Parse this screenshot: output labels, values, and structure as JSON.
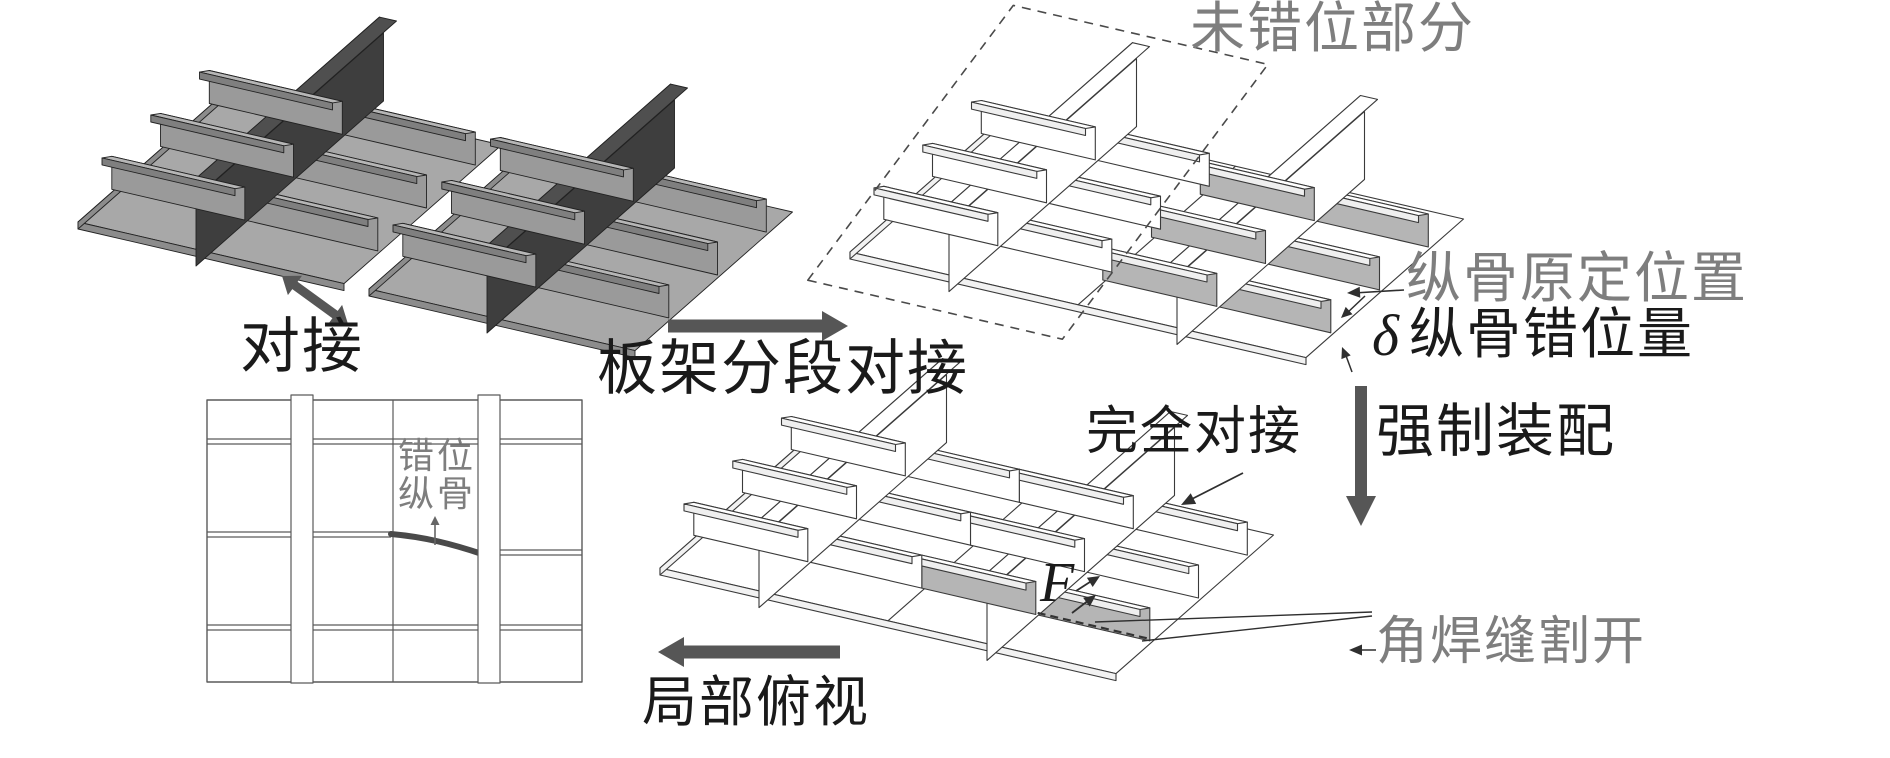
{
  "figure": {
    "labels": {
      "butt_join": "对接",
      "panel_section_butt": "板架分段对接",
      "unmisaligned_part": "未错位部分",
      "stiffener_original_position": "纵骨原定位置",
      "delta_symbol": "δ",
      "stiffener_misalignment": "纵骨错位量",
      "forced_assembly": "强制装配",
      "complete_butt": "完全对接",
      "force_symbol": "F",
      "fillet_weld_cut": "角焊缝割开",
      "local_top_view": "局部俯视",
      "misaligned_stiffener_line1": "错位",
      "misaligned_stiffener_line2": "纵骨"
    },
    "colors": {
      "ink": "#1a1a1a",
      "gray_text": "#7e7e7e",
      "arrow": "#565656",
      "plate": "#a8a8a8",
      "web": "#9a9a9a",
      "flange_top": "#b6b6b6",
      "flange_lip": "#7f7f7f",
      "plate_edge": "#8c8c8c",
      "frame_web": "#3e3e3e",
      "frame_flange": "#4f4f4f",
      "line_stroke": "#3a3a3a",
      "line_fill": "#ffffff",
      "shaded_web": "#b5b5b5",
      "flange_side_line": "#c2c2c2",
      "curve": "#4a4a4a",
      "grid_stroke": "#5a5a5a",
      "leader": "#2f2f2f"
    }
  }
}
